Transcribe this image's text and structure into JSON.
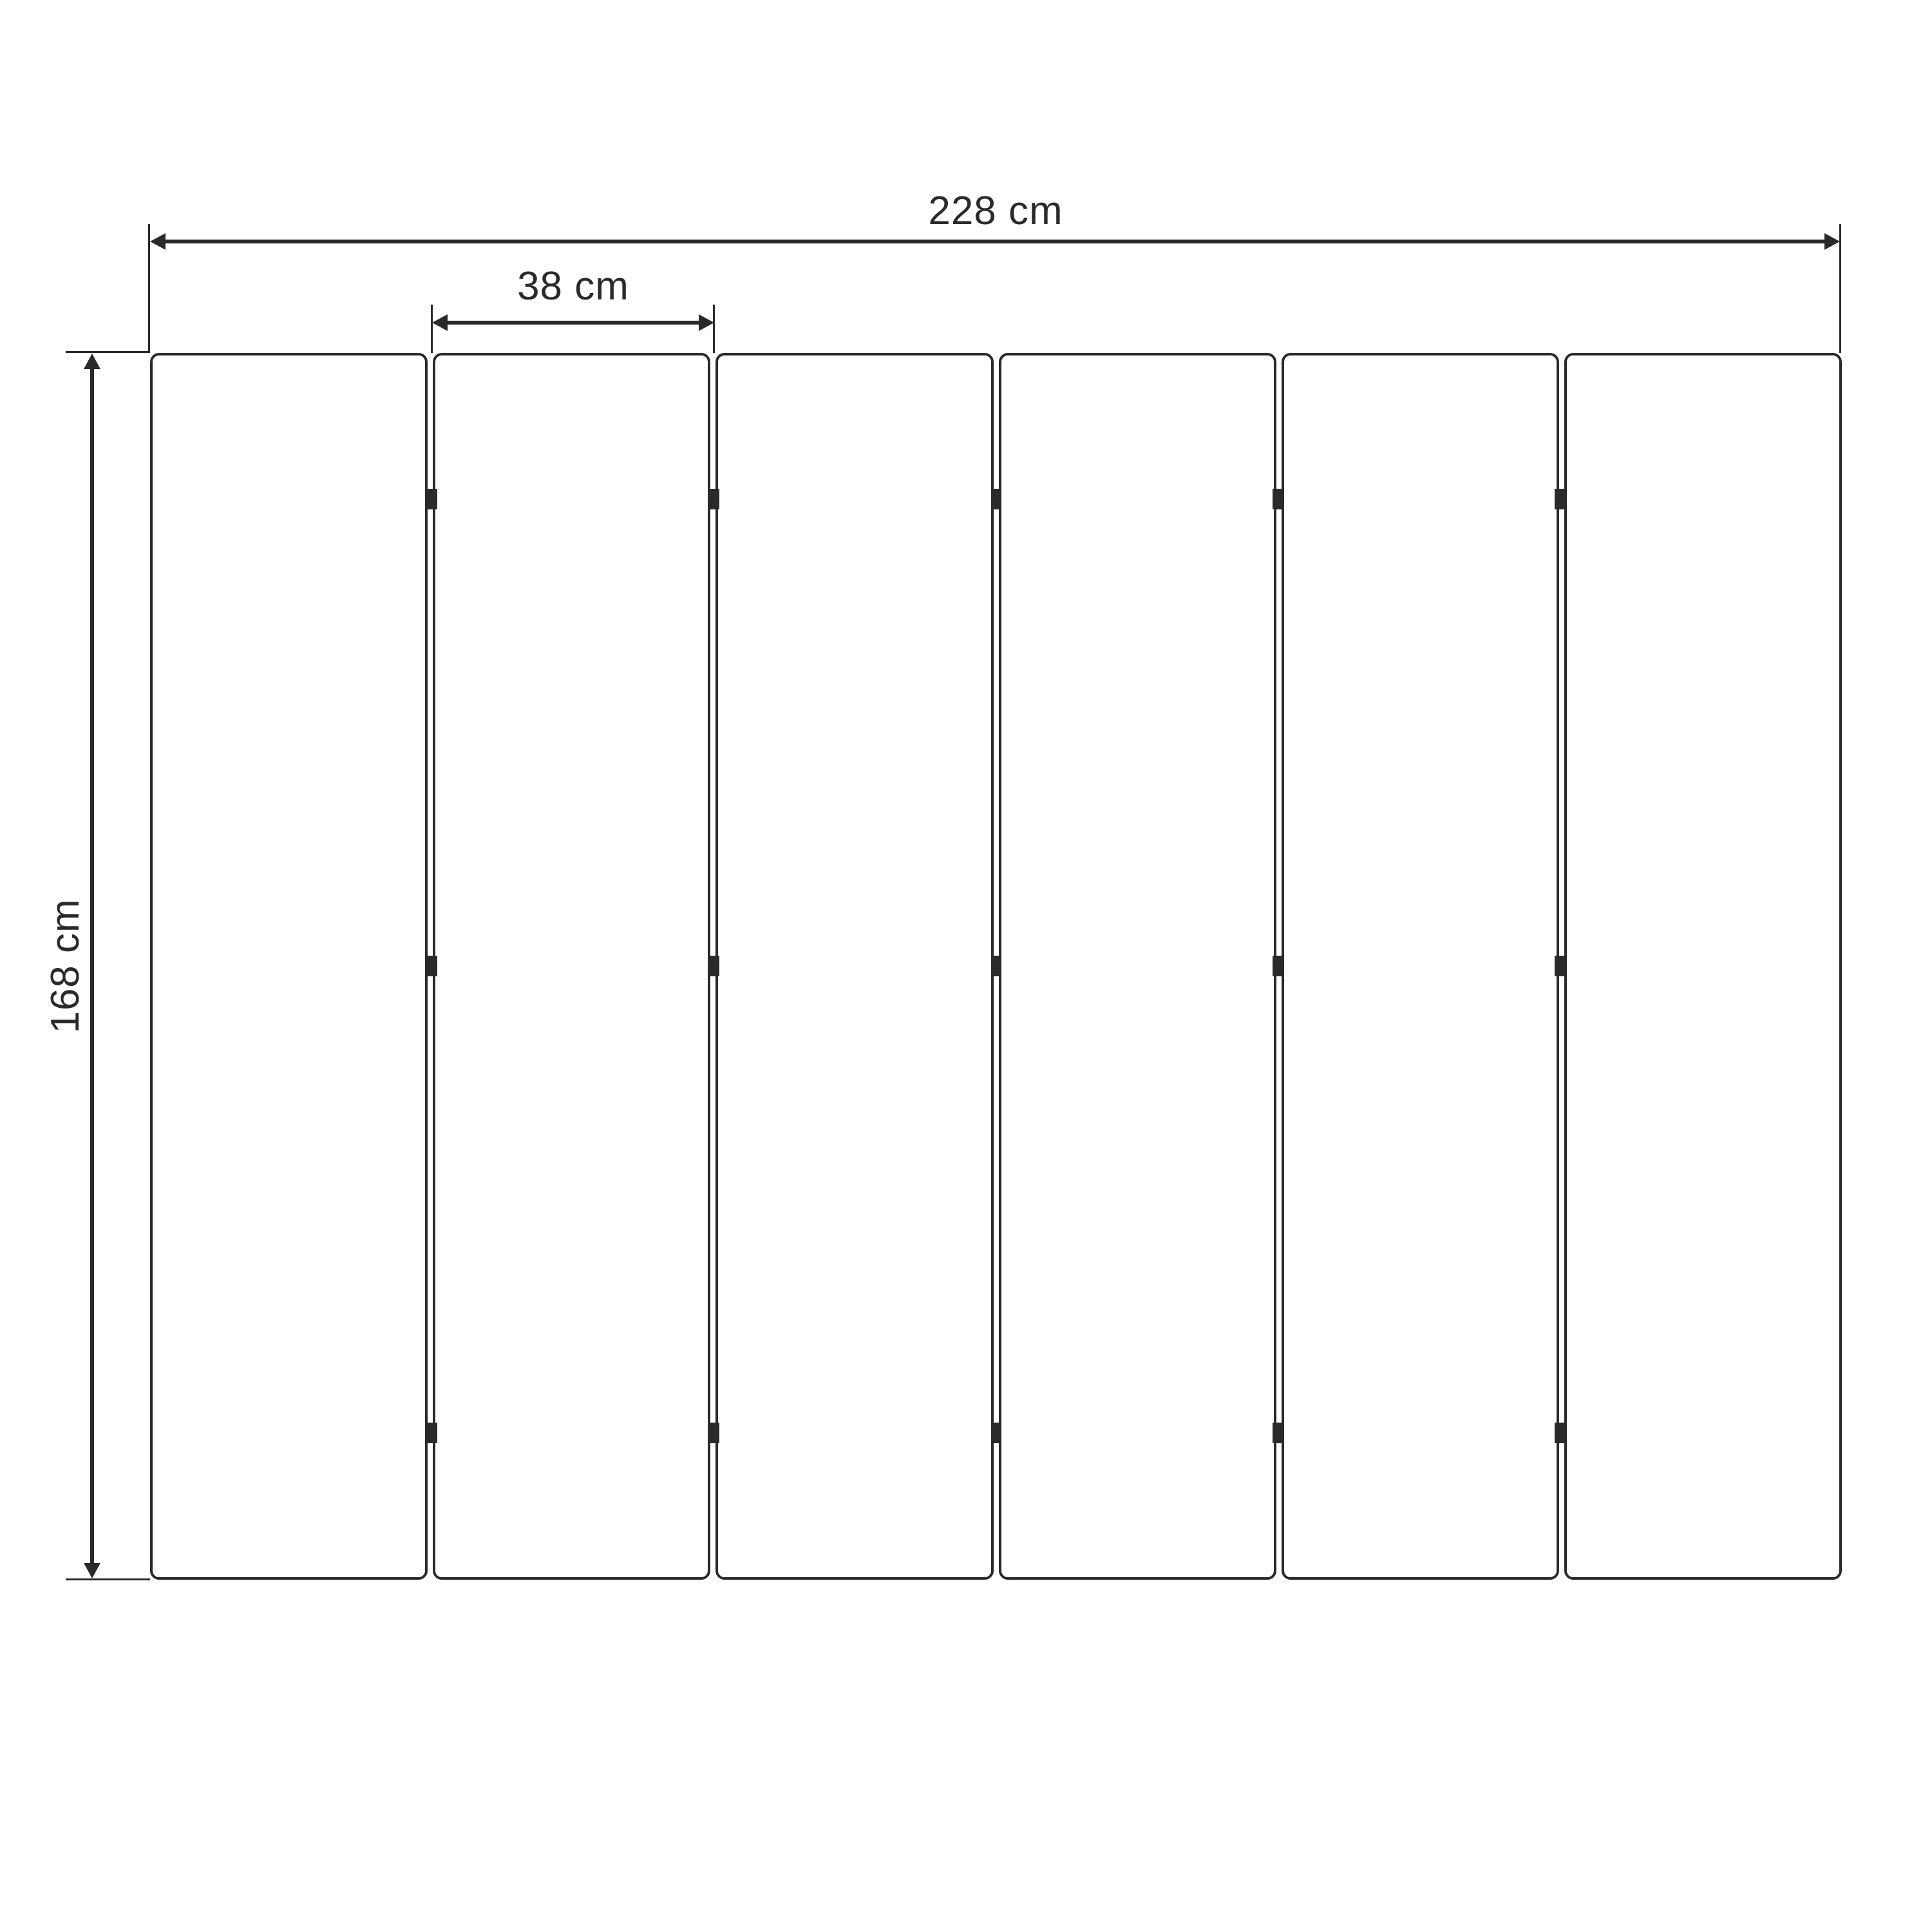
{
  "diagram": {
    "subject": "six-panel folding screen front elevation with dimensions"
  },
  "dimensions": {
    "total_width": {
      "label": "228 cm",
      "value": 228,
      "unit": "cm"
    },
    "panel_width": {
      "label": "38 cm",
      "value": 38,
      "unit": "cm"
    },
    "height": {
      "label": "168 cm",
      "value": 168,
      "unit": "cm"
    }
  },
  "panels": {
    "count": 6,
    "joints": 5,
    "hinges_per_joint": 3
  },
  "colors": {
    "ink": "#2a2a2a",
    "background": "#ffffff"
  }
}
